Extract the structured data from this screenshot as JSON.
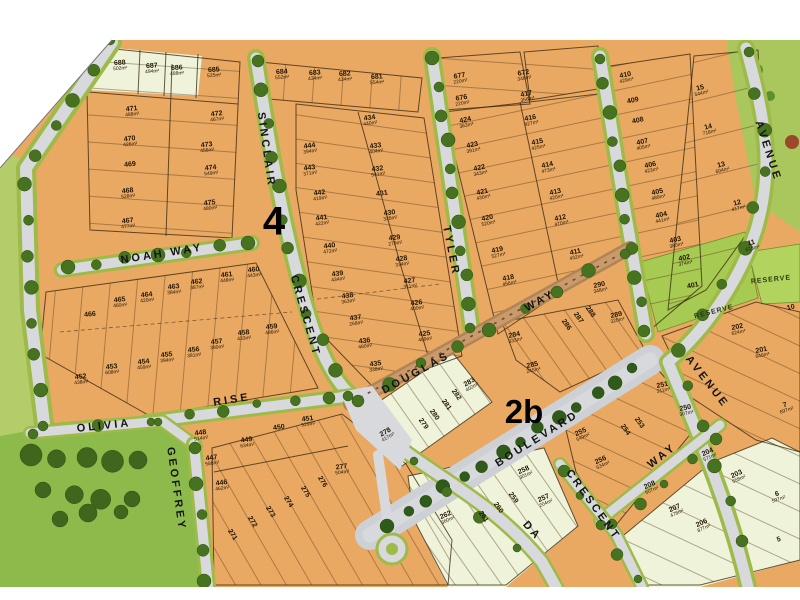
{
  "map": {
    "stage_labels": [
      {
        "text": "4",
        "x": 274,
        "y": 222,
        "size": 40,
        "rot": 0
      },
      {
        "text": "2b",
        "x": 524,
        "y": 412,
        "size": 33,
        "rot": 0
      }
    ],
    "street_labels": [
      {
        "text": "SINCLAIR",
        "x": 266,
        "y": 150,
        "rot": 82
      },
      {
        "text": "CRESCENT",
        "x": 305,
        "y": 316,
        "rot": 74
      },
      {
        "text": "NOAH  WAY",
        "x": 162,
        "y": 254,
        "rot": -9
      },
      {
        "text": "RISE",
        "x": 232,
        "y": 400,
        "rot": -9
      },
      {
        "text": "OLIVIA",
        "x": 104,
        "y": 426,
        "rot": -6
      },
      {
        "text": "GEOFFREY",
        "x": 176,
        "y": 489,
        "rot": 82
      },
      {
        "text": "TYLER",
        "x": 451,
        "y": 251,
        "rot": 79
      },
      {
        "text": "DOUGLAS",
        "x": 416,
        "y": 373,
        "rot": -29
      },
      {
        "text": "WAY",
        "x": 540,
        "y": 301,
        "rot": -29
      },
      {
        "text": "BOULEVARD",
        "x": 537,
        "y": 439,
        "rot": -32
      },
      {
        "text": "AVENUE",
        "x": 768,
        "y": 151,
        "rot": 72
      },
      {
        "text": "AVENUE",
        "x": 707,
        "y": 382,
        "rot": 52
      },
      {
        "text": "WAY",
        "x": 662,
        "y": 456,
        "rot": -38
      },
      {
        "text": "CRESCENT",
        "x": 593,
        "y": 505,
        "rot": 54
      },
      {
        "text": "DA",
        "x": 532,
        "y": 531,
        "rot": 48
      }
    ],
    "reserve_labels": [
      {
        "text": "RESERVE",
        "x": 714,
        "y": 312,
        "rot": -14
      },
      {
        "text": "RESERVE",
        "x": 771,
        "y": 280,
        "rot": -6
      }
    ],
    "lot_format": [
      "number",
      "area",
      "x",
      "y",
      "rotation"
    ],
    "lots": [
      [
        "688",
        "502m²",
        120,
        66,
        -4
      ],
      [
        "687",
        "494m²",
        152,
        69,
        -4
      ],
      [
        "686",
        "488m²",
        177,
        71,
        -4
      ],
      [
        "685",
        "525m²",
        214,
        73,
        -4
      ],
      [
        "684",
        "552m²",
        282,
        75,
        -4
      ],
      [
        "683",
        "434m²",
        315,
        76,
        -4
      ],
      [
        "682",
        "434m²",
        345,
        77,
        -4
      ],
      [
        "681",
        "554m²",
        377,
        80,
        -4
      ],
      [
        "677",
        "220m²",
        460,
        79,
        -10
      ],
      [
        "676",
        "220m²",
        462,
        101,
        -10
      ],
      [
        "672",
        "348m²",
        524,
        76,
        -10
      ],
      [
        "471",
        "488m²",
        132,
        112,
        -6
      ],
      [
        "472",
        "467m²",
        217,
        117,
        -6
      ],
      [
        "470",
        "426m²",
        130,
        142,
        -6
      ],
      [
        "473",
        "456m²",
        207,
        148,
        -6
      ],
      [
        "469",
        "",
        130,
        165,
        -6
      ],
      [
        "474",
        "549m²",
        211,
        171,
        -6
      ],
      [
        "468",
        "528m²",
        128,
        194,
        -6
      ],
      [
        "475",
        "480m²",
        210,
        206,
        -6
      ],
      [
        "467",
        "477m²",
        128,
        224,
        -6
      ],
      [
        "444",
        "394m²",
        310,
        149,
        -8
      ],
      [
        "443",
        "371m²",
        310,
        171,
        -8
      ],
      [
        "442",
        "419m²",
        320,
        196,
        -8
      ],
      [
        "441",
        "422m²",
        322,
        221,
        -8
      ],
      [
        "440",
        "472m²",
        330,
        249,
        -8
      ],
      [
        "439",
        "434m²",
        338,
        277,
        -8
      ],
      [
        "438",
        "363m²",
        348,
        299,
        -8
      ],
      [
        "437",
        "268m²",
        356,
        321,
        -8
      ],
      [
        "436",
        "480m²",
        365,
        344,
        -8
      ],
      [
        "435",
        "338m²",
        376,
        367,
        -8
      ],
      [
        "434",
        "440m²",
        370,
        121,
        -8
      ],
      [
        "433",
        "404m²",
        376,
        149,
        -8
      ],
      [
        "432",
        "541m²",
        378,
        172,
        -8
      ],
      [
        "431",
        "",
        382,
        194,
        -8
      ],
      [
        "430",
        "328m²",
        390,
        216,
        -8
      ],
      [
        "429",
        "279m²",
        395,
        241,
        -8
      ],
      [
        "428",
        "334m²",
        402,
        262,
        -8
      ],
      [
        "427",
        "311m²",
        410,
        284,
        -8
      ],
      [
        "426",
        "400m²",
        417,
        306,
        -8
      ],
      [
        "425",
        "489m²",
        425,
        337,
        -8
      ],
      [
        "424",
        "363m²",
        466,
        123,
        -12
      ],
      [
        "423",
        "391m²",
        473,
        148,
        -12
      ],
      [
        "422",
        "343m²",
        480,
        171,
        -12
      ],
      [
        "421",
        "430m²",
        483,
        195,
        -12
      ],
      [
        "420",
        "520m²",
        488,
        221,
        -12
      ],
      [
        "419",
        "527m²",
        498,
        253,
        -12
      ],
      [
        "418",
        "456m²",
        509,
        281,
        -12
      ],
      [
        "417",
        "356m²",
        527,
        97,
        -12
      ],
      [
        "416",
        "427m²",
        531,
        121,
        -12
      ],
      [
        "415",
        "425m²",
        538,
        145,
        -12
      ],
      [
        "414",
        "473m²",
        548,
        168,
        -12
      ],
      [
        "413",
        "420m²",
        556,
        195,
        -12
      ],
      [
        "412",
        "470m²",
        561,
        221,
        -12
      ],
      [
        "411",
        "432m²",
        576,
        255,
        -12
      ],
      [
        "290",
        "348m²",
        600,
        288,
        -12
      ],
      [
        "410",
        "429m²",
        626,
        78,
        -12
      ],
      [
        "409",
        "",
        633,
        101,
        -12
      ],
      [
        "408",
        "",
        638,
        121,
        -12
      ],
      [
        "407",
        "405m²",
        643,
        145,
        -12
      ],
      [
        "406",
        "423m²",
        651,
        168,
        -12
      ],
      [
        "405",
        "489m²",
        658,
        195,
        -12
      ],
      [
        "404",
        "441m²",
        662,
        218,
        -12
      ],
      [
        "403",
        "380m²",
        676,
        243,
        -12
      ],
      [
        "402",
        "374m²",
        685,
        261,
        -12
      ],
      [
        "401",
        "",
        693,
        286,
        -12
      ],
      [
        "15",
        "544m²",
        701,
        91,
        -14
      ],
      [
        "14",
        "718m²",
        709,
        130,
        -14
      ],
      [
        "13",
        "604m²",
        722,
        168,
        -14
      ],
      [
        "12",
        "417m²",
        738,
        206,
        -14
      ],
      [
        "11",
        "615m²",
        752,
        246,
        -14
      ],
      [
        "10",
        "",
        791,
        308,
        -14
      ],
      [
        "202",
        "624m²",
        738,
        330,
        -12
      ],
      [
        "201",
        "640m²",
        762,
        353,
        -12
      ],
      [
        "7",
        "697m²",
        786,
        408,
        -18
      ],
      [
        "6",
        "597m²",
        778,
        497,
        -18
      ],
      [
        "5",
        "",
        779,
        540,
        -18
      ],
      [
        "466",
        "",
        90,
        315,
        -6
      ],
      [
        "465",
        "460m²",
        120,
        303,
        -6
      ],
      [
        "464",
        "420m²",
        147,
        298,
        -6
      ],
      [
        "463",
        "384m²",
        174,
        290,
        -6
      ],
      [
        "462",
        "387m²",
        197,
        285,
        -6
      ],
      [
        "461",
        "448m²",
        227,
        278,
        -6
      ],
      [
        "460",
        "443m²",
        254,
        273,
        -6
      ],
      [
        "459",
        "486m²",
        272,
        330,
        -6
      ],
      [
        "458",
        "433m²",
        244,
        336,
        -6
      ],
      [
        "457",
        "390m²",
        217,
        345,
        -6
      ],
      [
        "456",
        "381m²",
        194,
        353,
        -6
      ],
      [
        "455",
        "394m²",
        167,
        358,
        -6
      ],
      [
        "454",
        "459m²",
        144,
        365,
        -6
      ],
      [
        "453",
        "608m²",
        112,
        370,
        -6
      ],
      [
        "452",
        "438m²",
        81,
        380,
        -6
      ],
      [
        "448",
        "514m²",
        201,
        436,
        -8
      ],
      [
        "449",
        "634m²",
        247,
        443,
        -8
      ],
      [
        "450",
        "",
        279,
        428,
        -8
      ],
      [
        "451",
        "529m²",
        308,
        422,
        -8
      ],
      [
        "447",
        "588m²",
        212,
        461,
        -8
      ],
      [
        "446",
        "462m²",
        222,
        486,
        -8
      ],
      [
        "277",
        "504m²",
        342,
        470,
        -8
      ],
      [
        "276",
        "",
        322,
        482,
        58
      ],
      [
        "275",
        "",
        305,
        492,
        58
      ],
      [
        "274",
        "",
        288,
        502,
        58
      ],
      [
        "273",
        "",
        270,
        512,
        58
      ],
      [
        "272",
        "",
        252,
        522,
        58
      ],
      [
        "271",
        "",
        232,
        535,
        58
      ],
      [
        "283",
        "402m²",
        471,
        385,
        -30
      ],
      [
        "282",
        "",
        456,
        395,
        55
      ],
      [
        "281",
        "",
        446,
        405,
        55
      ],
      [
        "280",
        "",
        434,
        415,
        55
      ],
      [
        "279",
        "",
        423,
        424,
        55
      ],
      [
        "278",
        "417m²",
        387,
        435,
        -30
      ],
      [
        "284",
        "333m²",
        515,
        338,
        -12
      ],
      [
        "285",
        "245m²",
        533,
        368,
        -12
      ],
      [
        "289",
        "320m²",
        617,
        318,
        -12
      ],
      [
        "288",
        "",
        590,
        312,
        55
      ],
      [
        "287",
        "",
        578,
        318,
        55
      ],
      [
        "286",
        "",
        566,
        325,
        55
      ],
      [
        "258",
        "301m²",
        525,
        473,
        -25
      ],
      [
        "257",
        "204m²",
        545,
        501,
        -25
      ],
      [
        "259",
        "",
        513,
        498,
        55
      ],
      [
        "260",
        "",
        498,
        508,
        55
      ],
      [
        "261",
        "",
        483,
        517,
        55
      ],
      [
        "262",
        "360m²",
        447,
        518,
        -25
      ],
      [
        "255",
        "549m²",
        582,
        435,
        -25
      ],
      [
        "256",
        "534m²",
        602,
        463,
        -25
      ],
      [
        "254",
        "",
        625,
        430,
        55
      ],
      [
        "253",
        "",
        639,
        423,
        55
      ],
      [
        "251",
        "311m²",
        663,
        388,
        -12
      ],
      [
        "250",
        "307m²",
        686,
        411,
        -12
      ],
      [
        "208",
        "507m²",
        651,
        488,
        -25
      ],
      [
        "207",
        "478m²",
        676,
        511,
        -25
      ],
      [
        "206",
        "877m²",
        703,
        526,
        -25
      ],
      [
        "204",
        "571m²",
        709,
        455,
        -25
      ],
      [
        "203",
        "558m²",
        738,
        477,
        -25
      ]
    ],
    "colors": {
      "lot_fill": "#e9a963",
      "cream_fill": "#eef3da",
      "road": "#d7d9dc",
      "verge": "#9eba48",
      "park": "#8cbb4b",
      "reserve": "#a6ca52",
      "tree": "#47721f",
      "douglas_pavement": "#c99a6b"
    }
  }
}
